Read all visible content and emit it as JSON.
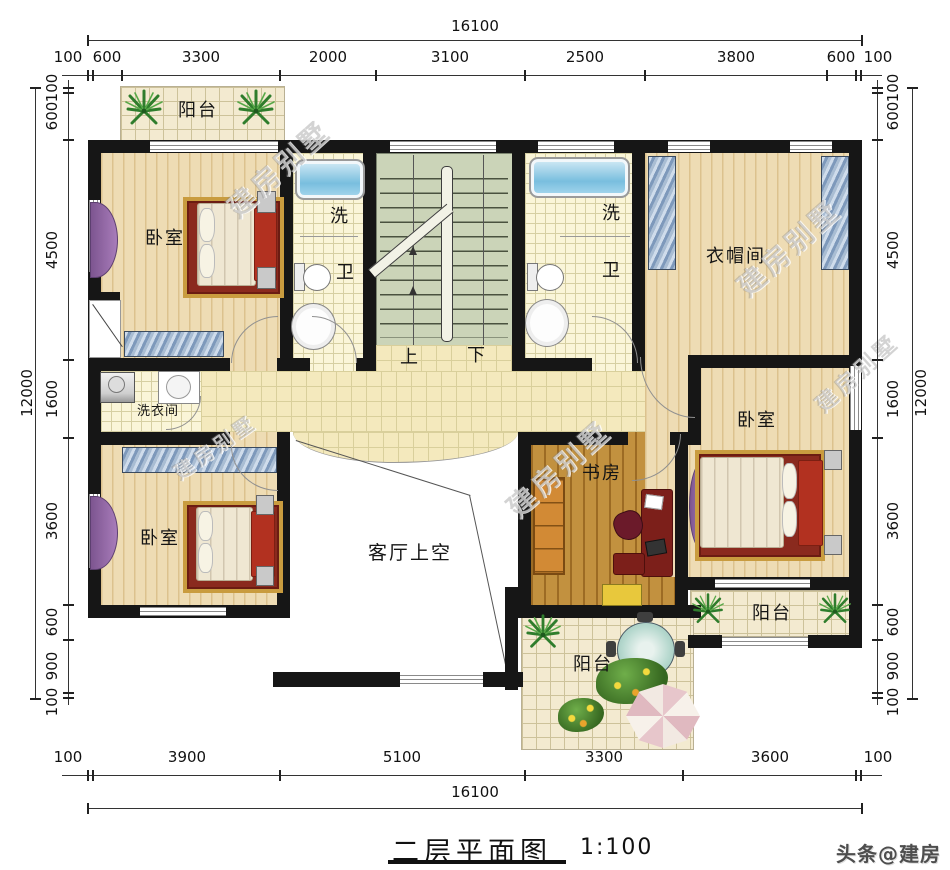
{
  "title": {
    "text": "二层平面图",
    "scale": "1:100"
  },
  "footer_watermark": "头条@建房别墅",
  "diagonal_watermark": "建房别墅",
  "labels": {
    "balcony": "阳台",
    "bedroom": "卧室",
    "wash": "洗",
    "toilet": "卫",
    "cloakroom": "衣帽间",
    "laundry": "洗衣间",
    "living_void": "客厅上空",
    "study": "书房",
    "up": "上",
    "down": "下"
  },
  "dims": {
    "top_total": "16100",
    "bottom_total": "16100",
    "left_total": "12000",
    "right_total": "12000",
    "top": [
      "100",
      "600",
      "3300",
      "2000",
      "3100",
      "2500",
      "3800",
      "600",
      "100"
    ],
    "bottom": [
      "100",
      "3900",
      "5100",
      "3300",
      "3600",
      "100"
    ],
    "left": [
      "100",
      "600",
      "4500",
      "1600",
      "3600",
      "600",
      "900",
      "100"
    ],
    "right": [
      "100",
      "600",
      "4500",
      "1600",
      "3600",
      "600",
      "900",
      "100"
    ]
  },
  "colors": {
    "wall": "#161616",
    "wood_floor": "#ecd9ad",
    "study_floor": "#c2913f",
    "hall_tile": "#f4e9bd",
    "bath_tile": "#faf5d8",
    "balcony_tile": "#f3ead0",
    "stair": "#cbd4b8",
    "wardrobe": "#7e99bb",
    "bed_frame": "#b23120",
    "accent_purple": "#9a6fae",
    "tub": "#79bede"
  }
}
